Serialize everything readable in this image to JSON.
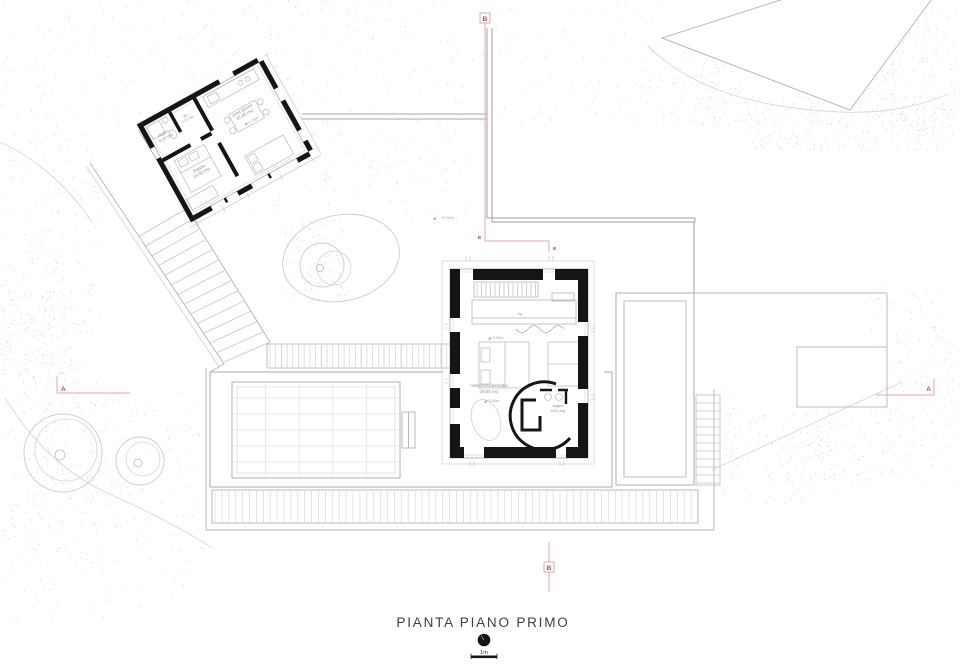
{
  "title": {
    "text": "PIANTA PIANO PRIMO",
    "scale_label": "1m"
  },
  "colors": {
    "wall": "#151515",
    "line": "#a6a6a6",
    "light_line": "#c9c9c9",
    "furniture": "#c2c2c2",
    "stipple": "#c3c3c3",
    "section_line": "#dcaaaa",
    "section_text": "#b04e4e",
    "label": "#8f8f8f",
    "title_text": "#3f3f3f"
  },
  "guesthouse": {
    "rooms": [
      {
        "name": "bagno",
        "area": "4.16 mq"
      },
      {
        "name": "dis.",
        "area": "2.07 mq"
      },
      {
        "name": "zona giorno",
        "area": "22.68 mq",
        "level": "+1.73m"
      },
      {
        "name": "doppia",
        "area": "14.30 mq"
      }
    ]
  },
  "main_house": {
    "rooms": [
      {
        "name": "rip"
      },
      {
        "name": "matrimoniale/studio",
        "area": "39.85 mq",
        "level": "+2.00m"
      },
      {
        "name": "bagno",
        "area": "8.64 mq"
      }
    ],
    "upper_level_mark": "+2.00m",
    "courtyard_level_mark": "+2.00m"
  },
  "sections": {
    "a": "A",
    "b": "B"
  }
}
